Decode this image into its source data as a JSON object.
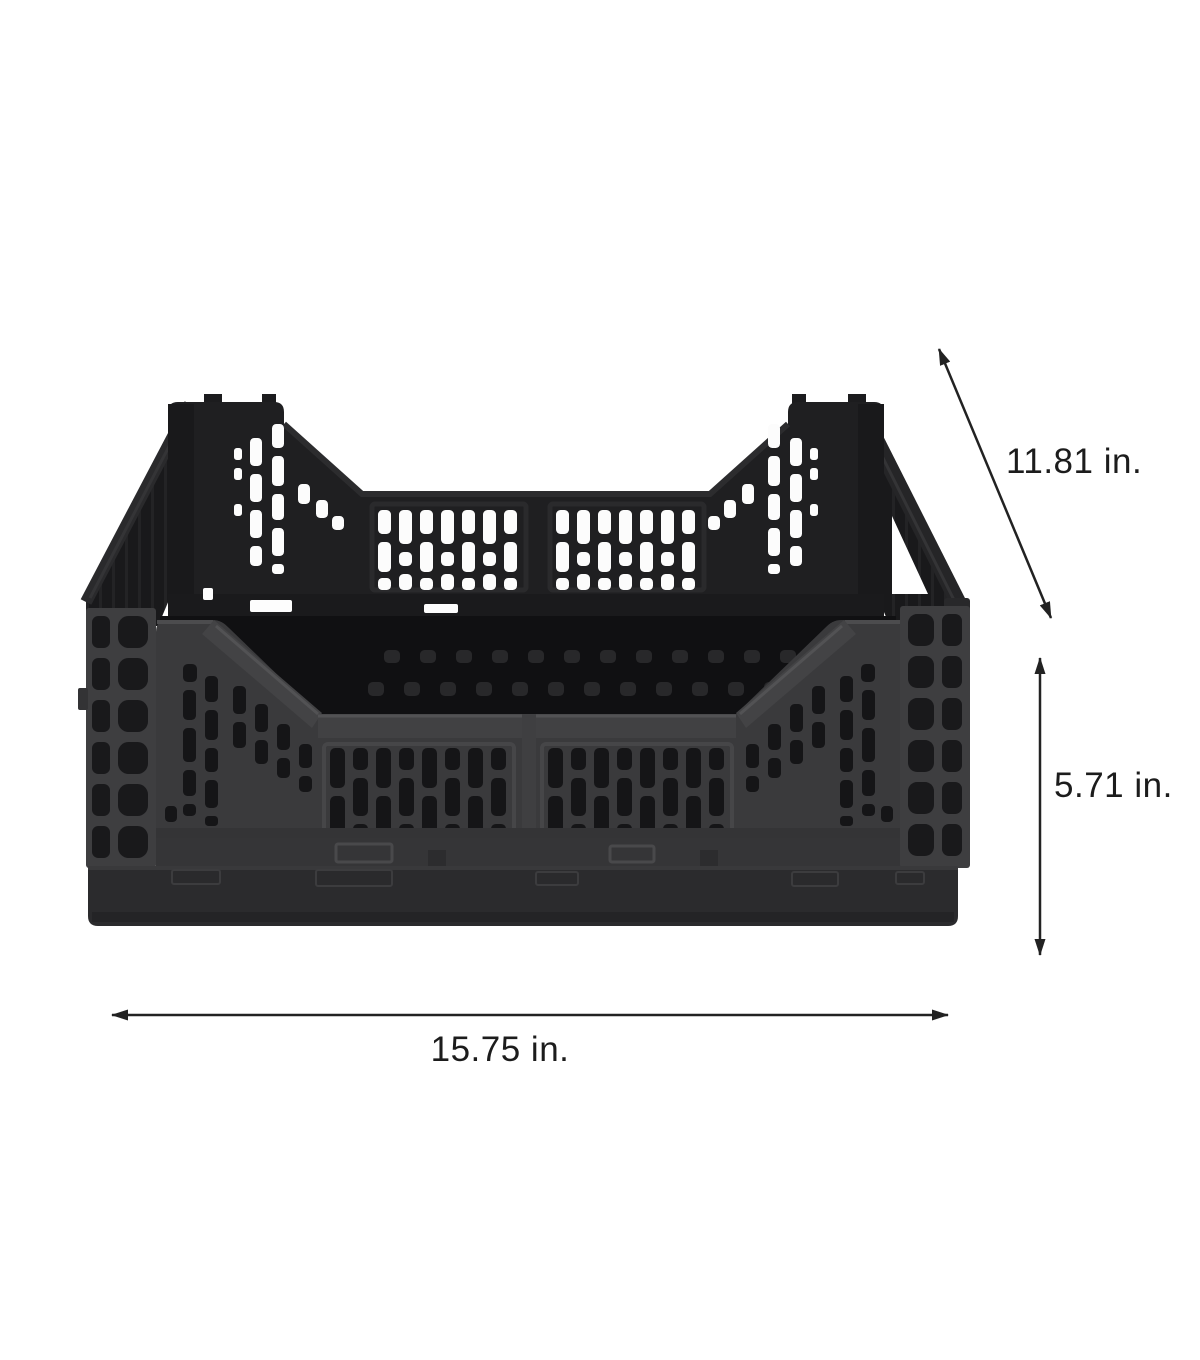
{
  "figure": {
    "alt": "Black collapsible folding storage crate shown with measurement arrows"
  },
  "dimensions": {
    "depth": {
      "label": "11.81 in.",
      "value": 11.81,
      "unit": "in"
    },
    "height": {
      "label": "5.71 in.",
      "value": 5.71,
      "unit": "in"
    },
    "width": {
      "label": "15.75 in.",
      "value": 15.75,
      "unit": "in"
    }
  },
  "colors": {
    "background": "#ffffff",
    "annotation": "#1c1c1c",
    "crate_dark": "#1f1f21",
    "crate_mid": "#3a3a3c",
    "crate_base": "#2c2c2e"
  }
}
